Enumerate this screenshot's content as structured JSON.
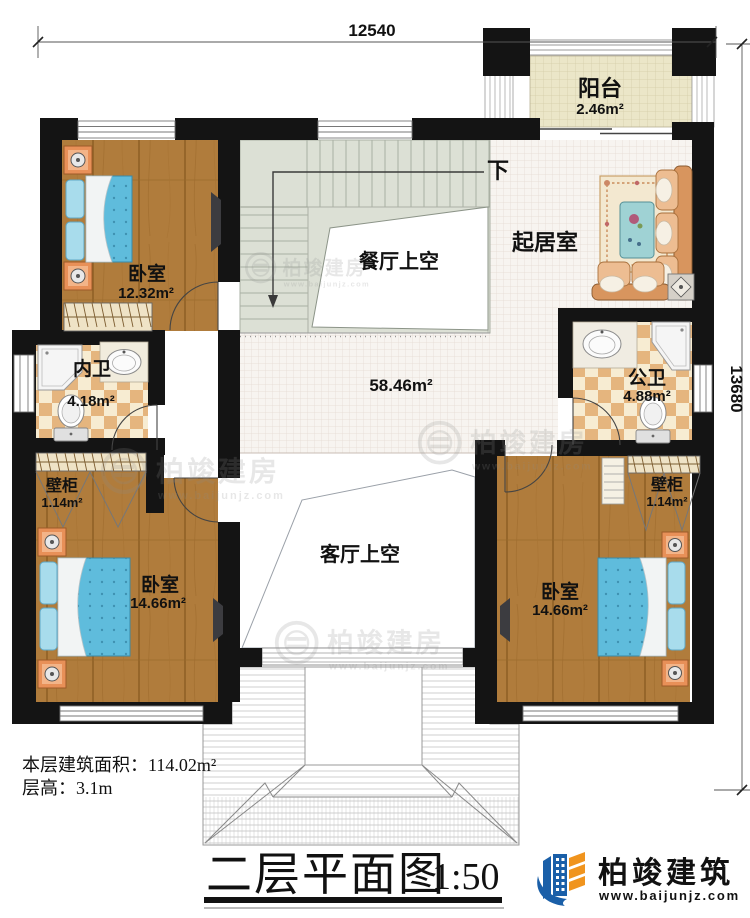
{
  "plan": {
    "dimensions": {
      "top": "12540",
      "right": "13680"
    },
    "rooms": {
      "balcony": {
        "name": "阳台",
        "area": "2.46m²"
      },
      "living": {
        "name": "起居室"
      },
      "stairs": {
        "label": "下"
      },
      "dining_void": {
        "name": "餐厅上空"
      },
      "hall": {
        "area": "58.46m²"
      },
      "lounge_void": {
        "name": "客厅上空"
      },
      "bedroom_top_left": {
        "name": "卧室",
        "area": "12.32m²"
      },
      "bedroom_bottom_left": {
        "name": "卧室",
        "area": "14.66m²"
      },
      "bedroom_bottom_right": {
        "name": "卧室",
        "area": "14.66m²"
      },
      "bath_private": {
        "name": "内卫",
        "area": "4.18m²"
      },
      "bath_public": {
        "name": "公卫",
        "area": "4.88m²"
      },
      "closet_left": {
        "name": "壁柜",
        "area": "1.14m²"
      },
      "closet_right": {
        "name": "壁柜",
        "area": "1.14m²"
      }
    },
    "info": {
      "area_label": "本层建筑面积：",
      "area_value": "114.02m²",
      "height_label": "层高：",
      "height_value": "3.1m"
    },
    "title": {
      "text": "二层平面图",
      "scale": "1:50"
    },
    "brand": {
      "name": "柏竣建筑",
      "url": "www.baijunjz.com"
    },
    "watermark": {
      "name": "柏竣建房",
      "url": "www.baijunjz.com"
    },
    "colors": {
      "wall": "#141414",
      "wood": "#b07c3c",
      "tile_checker": "#e5b57e",
      "stair": "#dce0d5",
      "bed": "#5fbcdc",
      "brand_blue": "#1a5fa8",
      "brand_orange": "#f0941e"
    }
  }
}
